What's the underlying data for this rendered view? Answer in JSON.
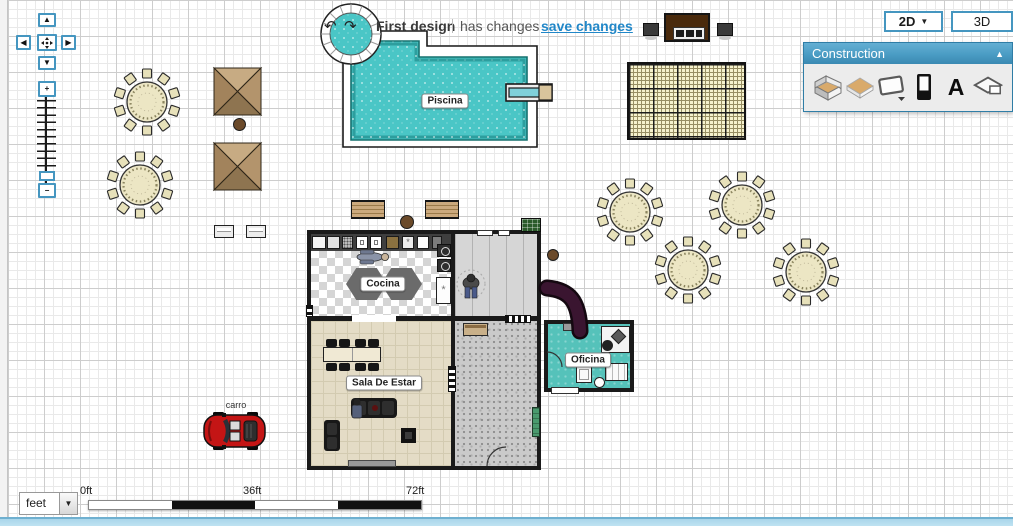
{
  "titlebar": {
    "undo_glyph": "↶",
    "redo_glyph": "↷",
    "title": "First design",
    "status": "has changes",
    "save": "save changes"
  },
  "view_switch": {
    "mode_2d": "2D",
    "caret": "▼",
    "mode_3d": "3D"
  },
  "construction_panel": {
    "title": "Construction",
    "collapse_glyph": "▲",
    "text_tool_glyph": "A",
    "tools": [
      {
        "name": "build-walls"
      },
      {
        "name": "draw-surface"
      },
      {
        "name": "place-window"
      },
      {
        "name": "place-door"
      },
      {
        "name": "place-text"
      },
      {
        "name": "draw-surfaces"
      }
    ]
  },
  "nav": {
    "up": "▲",
    "down": "▼",
    "left": "◀",
    "right": "▶",
    "zoom_in": "+",
    "zoom_out": "−"
  },
  "rooms": {
    "pool": "Piscina",
    "kitchen": "Cocina",
    "living": "Sala De Estar",
    "office": "Oficina"
  },
  "objects": {
    "car_label": "carro"
  },
  "scalebar": {
    "unit": "feet",
    "caret": "▼",
    "ticks": [
      "0ft",
      "36ft",
      "72ft"
    ]
  },
  "colors": {
    "accent_blue": "#4596c0",
    "panel_header_blue": "#4a9cc4",
    "link_blue": "#2187c8",
    "pool_water": "#4ac6c6",
    "office_floor": "#55c2ba",
    "car_red": "#c41515"
  }
}
